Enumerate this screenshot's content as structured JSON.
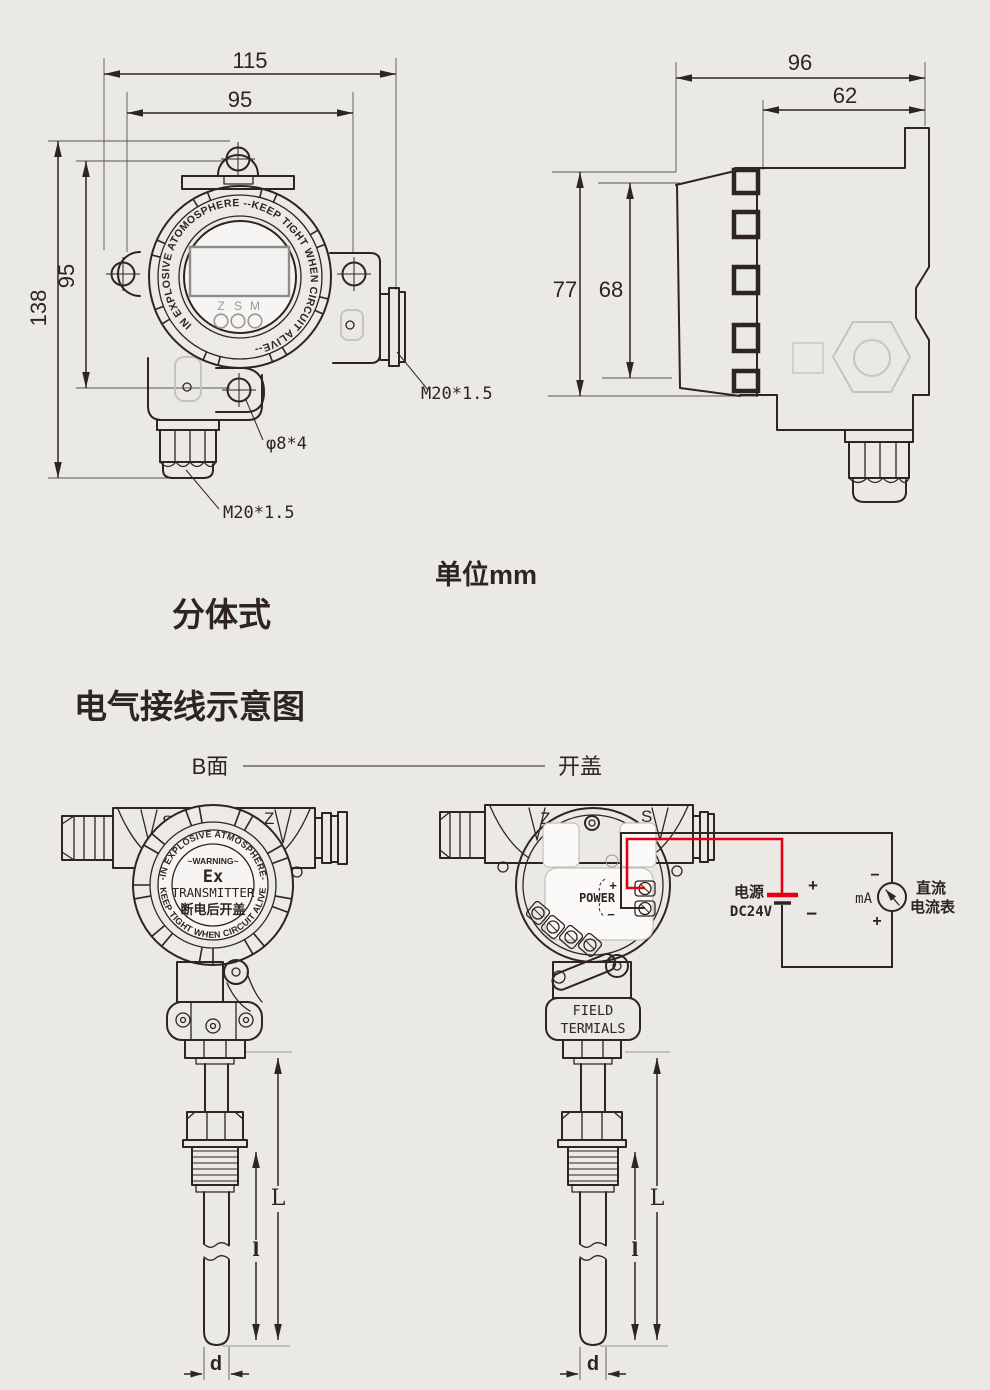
{
  "colors": {
    "background": "#eae9e6",
    "line": "#2e2420",
    "wire_red": "#e60012",
    "ghost": "#c7c4c0",
    "muted_text": "#9b9894"
  },
  "front_view": {
    "dim_width_outer": "115",
    "dim_width_inner": "95",
    "dim_height_outer": "138",
    "dim_height_inner": "95",
    "ring_text": "IN EXPLOSIVE ATOMOSPHERE --KEEP TIGHT WHEN CIRCUIT ALIVE--",
    "button_labels": {
      "z": "Z",
      "s": "S",
      "m": "M"
    },
    "gland_side_label": "M20*1.5",
    "screw_holes_label": "φ8*4",
    "gland_bottom_label": "M20*1.5"
  },
  "side_view": {
    "dim_width_outer": "96",
    "dim_width_inner": "62",
    "dim_height_outer": "77",
    "dim_height_inner": "68"
  },
  "captions": {
    "units": "单位mm",
    "variant": "分体式",
    "wiring_title": "电气接线示意图",
    "label_b_side": "B面",
    "label_open_cover": "开盖"
  },
  "device_b": {
    "corner_left": "S",
    "corner_right": "Z",
    "ring_top": "-IN EXPLOSIVE ATMOSPHERE-",
    "ring_bottom": "KEEP TIGHT WHEN CIRCUIT ALIVE",
    "warning": "~WARNING~",
    "ex_mark": "Ex",
    "transmitter": "TRANSMITTER",
    "open_note": "断电后开盖",
    "dim_total": "L",
    "dim_insert": "l",
    "dim_diameter": "d"
  },
  "device_open": {
    "corner_left": "Z",
    "corner_right": "S",
    "power_label": "POWER",
    "plus": "+",
    "minus": "−",
    "field_line1": "FIELD",
    "field_line2": "TERMIALS",
    "dim_total": "L",
    "dim_insert": "l",
    "dim_diameter": "d"
  },
  "circuit": {
    "supply_name": "电源",
    "supply_voltage": "DC24V",
    "battery_plus": "+",
    "battery_minus": "−",
    "meter_minus": "−",
    "meter_plus": "+",
    "meter_unit": "mA",
    "meter_name_line1": "直流",
    "meter_name_line2": "电流表"
  }
}
